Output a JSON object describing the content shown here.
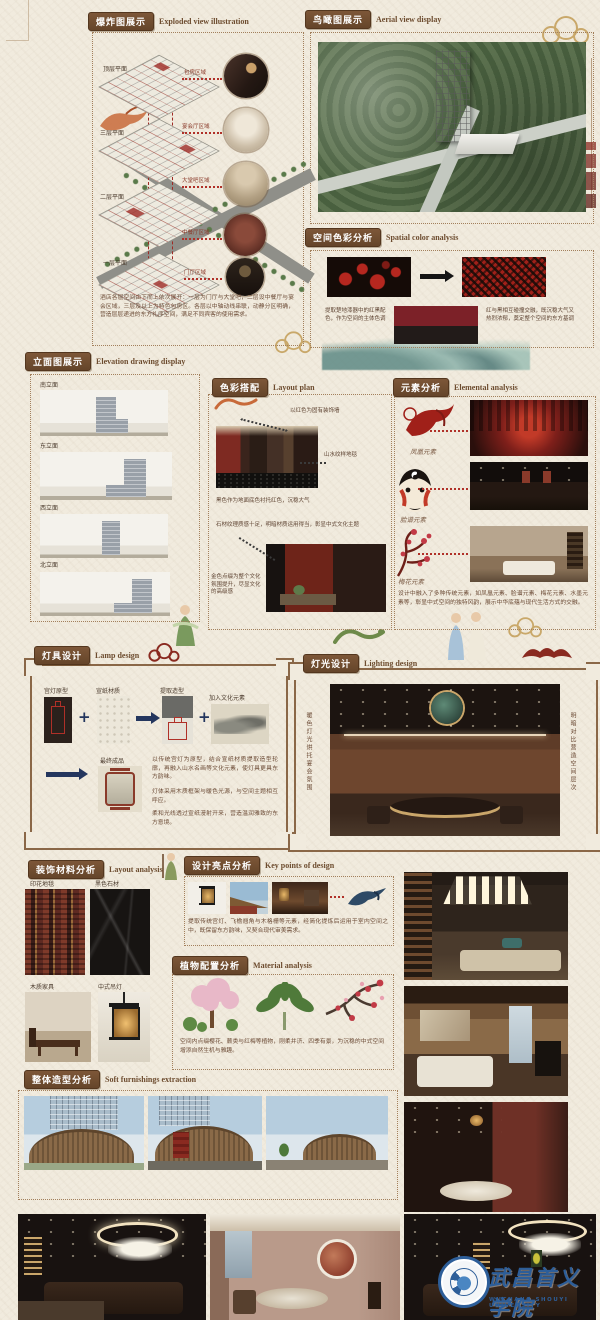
{
  "page": {
    "bg_color": "#f1ebde",
    "accent_brown": "#6f4c2e",
    "accent_red": "#9e2b25"
  },
  "headers": {
    "exploded": {
      "zh": "爆炸图展示",
      "en": "Exploded view illustration"
    },
    "aerial": {
      "zh": "鸟瞰图展示",
      "en": "Aerial view display"
    },
    "color": {
      "zh": "空间色彩分析",
      "en": "Spatial color analysis"
    },
    "elevation": {
      "zh": "立面图展示",
      "en": "Elevation drawing display"
    },
    "layout": {
      "zh": "色彩搭配",
      "en": "Layout plan"
    },
    "elements": {
      "zh": "元素分析",
      "en": "Elemental analysis"
    },
    "lamp": {
      "zh": "灯具设计",
      "en": "Lamp design"
    },
    "lighting": {
      "zh": "灯光设计",
      "en": "Lighting design"
    },
    "materials": {
      "zh": "装饰材料分析",
      "en": "Layout analysis"
    },
    "keypoints": {
      "zh": "设计亮点分析",
      "en": "Key points of design"
    },
    "plants": {
      "zh": "植物配置分析",
      "en": "Material analysis"
    },
    "massing": {
      "zh": "整体造型分析",
      "en": "Soft furnishings extraction"
    }
  },
  "exploded": {
    "floors": [
      "顶层平面",
      "三层平面",
      "二层平面",
      "一层平面"
    ],
    "callouts": [
      "包房区域",
      "宴会厅区域",
      "大堂吧区域",
      "中餐厅区域",
      "门厅区域"
    ],
    "description": "酒店各层空间由下而上依次展开：一层为门厅与大堂吧，二层设中餐厅与宴会区域，三层及以上为特色包房区。各层以中轴动线串联，动静分区明确，营造层层递进的东方礼序空间，满足不同宾客的使用需求。"
  },
  "color": {
    "left_note": "提取楚地漆器中的红黑配色，作为空间的主体色调",
    "right_note": "红与黑相互碰撞交融，既沉稳大气又热烈浓郁，奠定整个空间的东方基调",
    "swatch_top": "#7c2128",
    "swatch_bottom": "#221b19"
  },
  "elevation": {
    "labels": [
      "南立面",
      "东立面",
      "西立面",
      "北立面"
    ]
  },
  "layout": {
    "note_red_wall": "以红色为固有装饰墙",
    "note_carpet": "山水纹样地毯",
    "note_floor": "黑色作为地面底色衬托红色，沉稳大气",
    "note_stone": "石材纹理质感十足，明暗材质运用得当，彰显中式文化主题",
    "note_gold": "金色点缀为整个文化氛围提升，尽显文化的高级感"
  },
  "elements": {
    "items": [
      {
        "label": "凤凰元素"
      },
      {
        "label": "脸谱元素"
      },
      {
        "label": "梅花元素"
      }
    ],
    "description": "设计中融入了多种传统元素，如凤凰元素、脸谱元素、梅花元素、水墨元素等，彰显中式空间的独特风韵，展示中华底蕴与现代生活方式的交融。"
  },
  "lamp": {
    "steps": [
      "宫灯原型",
      "宣纸材质",
      "提取造型",
      "加入文化元素"
    ],
    "plus": "+",
    "final_label": "最终成品",
    "para1": "以传统宫灯为原型，结合宣纸材质提取造型轮廓，再融入山水名画等文化元素，使灯具更具东方韵味。",
    "para2": "灯体采用木质框架与暖色光源，与空间主题相互呼应。",
    "para3": "柔和光线透过宣纸漫射开来，营造温润雅致的东方意境。"
  },
  "lighting": {
    "left_note": "暖色灯光烘托宴会氛围",
    "right_note": "明暗对比营造空间层次"
  },
  "materials": {
    "labels": [
      "印花地毯",
      "黑色石材",
      "木质家具",
      "中式吊灯"
    ]
  },
  "keypoints": {
    "description": "提取传统宫灯、飞檐翘角与木格栅等元素，经简化提炼后运用于室内空间之中，既保留东方韵味，又契合现代审美需求。"
  },
  "plants": {
    "description": "空间内点缀樱花、蕨类与红梅等植物，刚柔并济、四季有景，为沉稳的中式空间增添自然生机与雅趣。"
  },
  "logo": {
    "zh": "武昌首义学院",
    "en": "WUCHANG SHOUYI UNIVERSITY"
  }
}
